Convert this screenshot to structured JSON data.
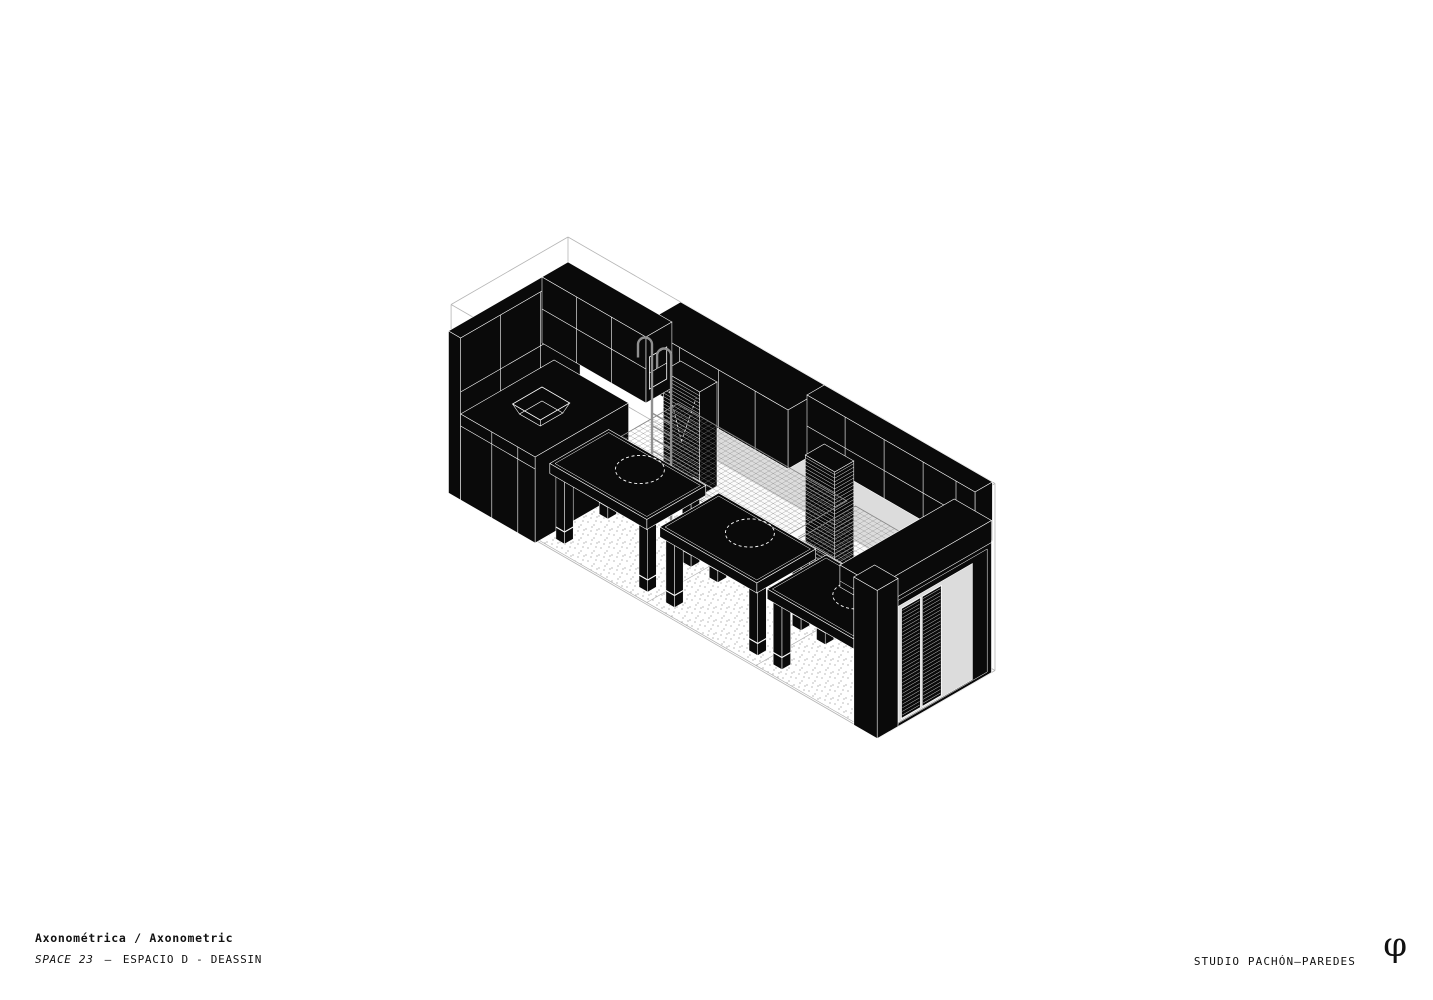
{
  "footer": {
    "title_primary": "Axonométrica / Axonometric",
    "subtitle_code": "SPACE 23",
    "subtitle_separator": "—",
    "subtitle_project": "ESPACIO D - DEASSIN",
    "studio": "STUDIO PACHÓN—PAREDES",
    "logo_glyph": "φ"
  },
  "drawing": {
    "description": "Axonometric of long room: kitchen block with sink at left, rear wall of black cabinets with slatted shutters and three grey openings, ribbon desk, three black tables with dashed basin outlines, two net platforms, hooked ladder, black portal wardrobe with slatted doors at right, stippled floor",
    "colors": {
      "black": "#0a0a0a",
      "hairline": "#ffffff",
      "wireframe": "#b5b5b5",
      "opening": "#dcdcdc",
      "mesh": "#8a8a8a",
      "ladder": "#909090",
      "dot": "#9a9a9a",
      "floor_line": "#b0b0b0",
      "desk_fill": "#fbfbfb",
      "desk_stroke": "#989898",
      "opening_stroke": "#a8a8a8"
    }
  }
}
